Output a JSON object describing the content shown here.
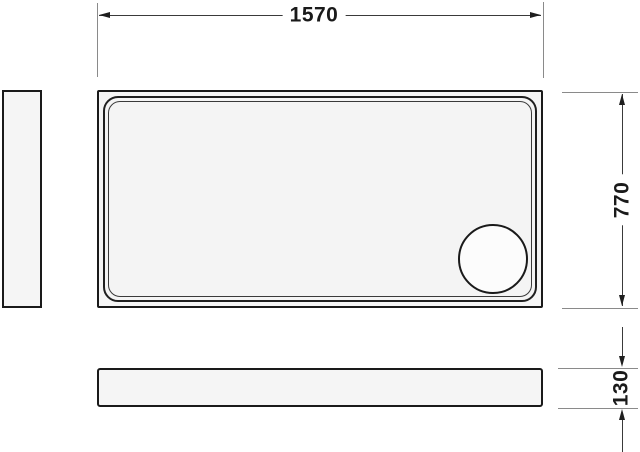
{
  "drawing": {
    "type": "technical-dimension-drawing",
    "dimensions": {
      "width": {
        "label": "1570"
      },
      "depth": {
        "label": "770"
      },
      "height": {
        "label": "130"
      }
    },
    "colors": {
      "background": "#ffffff",
      "outline": "#1a1a1a",
      "panel_fill": "#f5f5f5",
      "extension_line": "#8a8a8a",
      "dimension_line": "#3a3a3a",
      "label_text": "#1a1a1a"
    }
  }
}
